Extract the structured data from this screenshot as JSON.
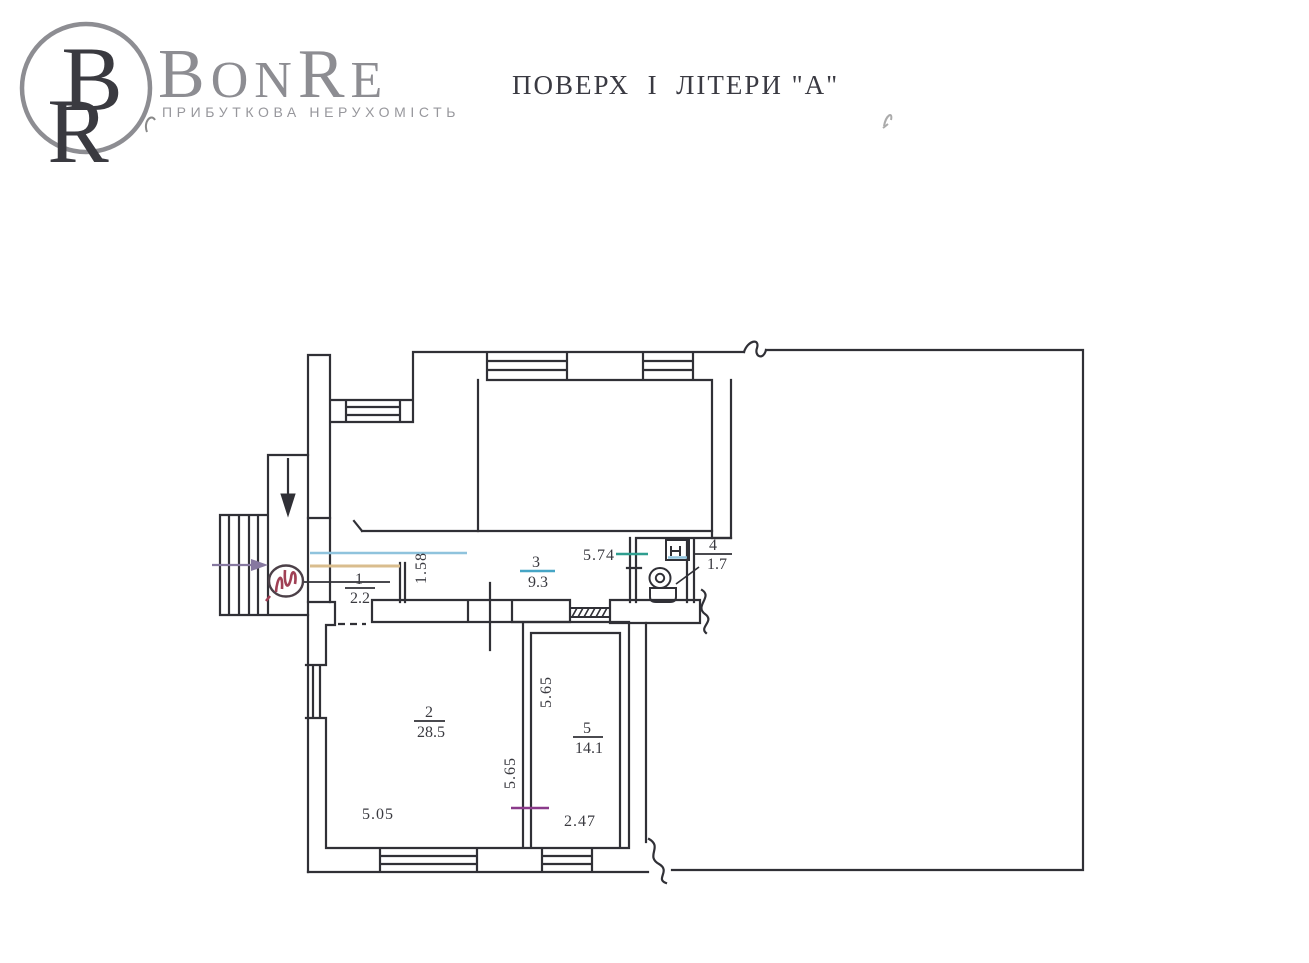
{
  "header": {
    "brand_parts": [
      "B",
      "ON",
      "R",
      "E"
    ],
    "monogram_top": "B",
    "monogram_bottom": "R",
    "tagline": "ПРИБУТКОВА НЕРУХОМІСТЬ",
    "title": "ПОВЕРХ  І  ЛІТЕРИ \"А\""
  },
  "plan": {
    "rooms": [
      {
        "number": "1",
        "area": "2.2"
      },
      {
        "number": "2",
        "area": "28.5"
      },
      {
        "number": "3",
        "area": "9.3"
      },
      {
        "number": "4",
        "area": "1.7"
      },
      {
        "number": "5",
        "area": "14.1"
      }
    ],
    "dimensions": {
      "corridor_width": "1.58",
      "corridor_length": "5.74",
      "room2_width": "5.05",
      "room2_depth": "5.65",
      "room5_depth": "5.65",
      "room5_width": "2.47"
    },
    "colors": {
      "ink": "#33333a",
      "cyan_line": "#8fc3dd",
      "tan_line": "#d9bd8e",
      "teal_tick": "#2f9e8f",
      "cyan_bar": "#46a5c5",
      "purple_line": "#8a3a8a",
      "purple_arrow": "#8678a0",
      "red_mark": "#a04055",
      "logo_gray": "#8d8d92"
    }
  }
}
